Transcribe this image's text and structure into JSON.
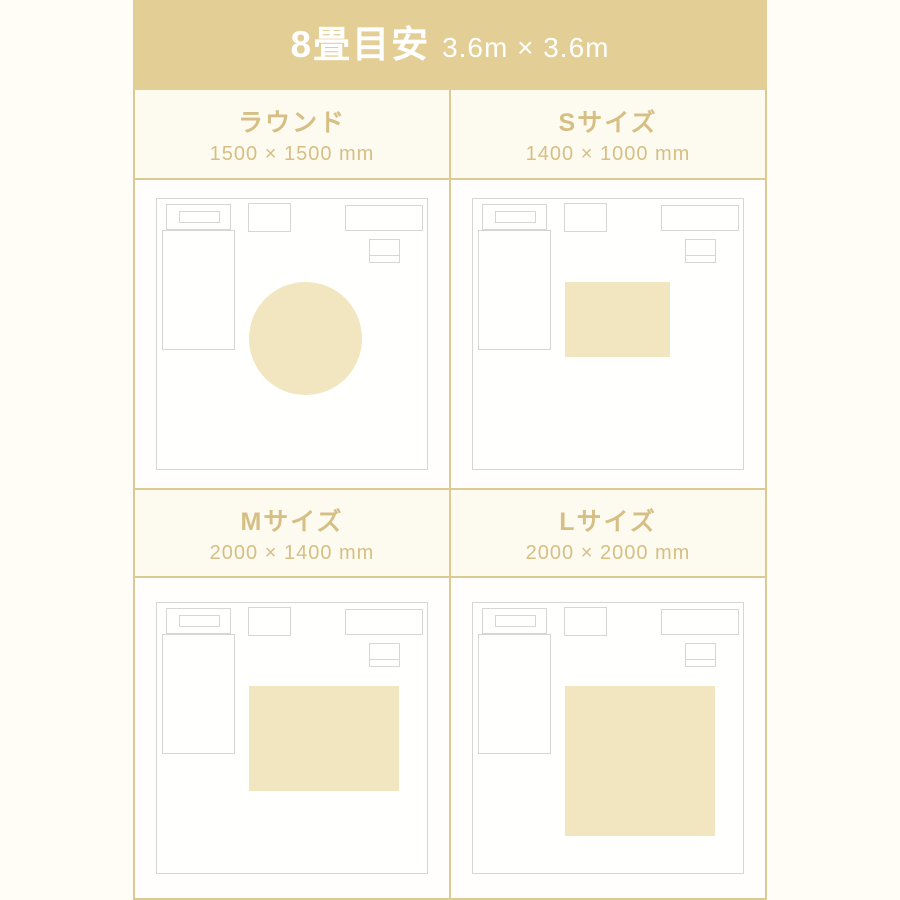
{
  "header": {
    "title": "8畳目安",
    "subtitle": "3.6m × 3.6m"
  },
  "room_mm": {
    "width": 3600,
    "height": 3600
  },
  "panels": [
    {
      "id": "round",
      "title": "ラウンド",
      "dimensions": "1500 × 1500 mm",
      "rug": {
        "shape": "circle",
        "width_mm": 1500,
        "height_mm": 1500
      }
    },
    {
      "id": "s",
      "title": "Sサイズ",
      "dimensions": "1400 × 1000 mm",
      "rug": {
        "shape": "rect",
        "width_mm": 1400,
        "height_mm": 1000
      }
    },
    {
      "id": "m",
      "title": "Mサイズ",
      "dimensions": "2000 × 1400 mm",
      "rug": {
        "shape": "rect",
        "width_mm": 2000,
        "height_mm": 1400
      }
    },
    {
      "id": "l",
      "title": "Lサイズ",
      "dimensions": "2000 × 2000 mm",
      "rug": {
        "shape": "rect",
        "width_mm": 2000,
        "height_mm": 2000
      }
    }
  ],
  "colors": {
    "page_bg": "#fffdf6",
    "header_bg": "#e3cf96",
    "header_text": "#ffffff",
    "panel_header_bg": "#fdfaf0",
    "diagram_bg": "#fffefc",
    "accent_text": "#d6bf84",
    "border": "#ddca92",
    "outline": "#d6d6d6",
    "rug": "#f2e6c1"
  }
}
